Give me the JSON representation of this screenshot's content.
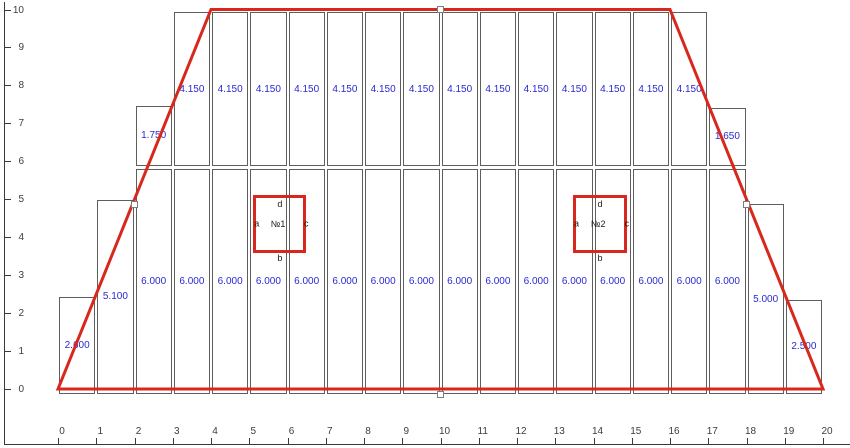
{
  "canvas": {
    "width": 850,
    "height": 448,
    "background": "#ffffff"
  },
  "colors": {
    "envelope_red": "#d8281e",
    "value_blue": "#2a2ace",
    "cell_border_gray": "#5e5e5e",
    "axis_gray": "#3a3a3a",
    "handle_fill": "#ffffff",
    "handle_border": "#7d7d7d"
  },
  "axes": {
    "x": {
      "min": 0,
      "max": 20,
      "tick_labels": [
        "0",
        "1",
        "2",
        "3",
        "4",
        "5",
        "6",
        "7",
        "8",
        "9",
        "10",
        "11",
        "12",
        "13",
        "14",
        "15",
        "16",
        "17",
        "18",
        "19",
        "20"
      ]
    },
    "y": {
      "min": 0,
      "max": 10,
      "tick_labels": [
        "0",
        "1",
        "2",
        "3",
        "4",
        "5",
        "6",
        "7",
        "8",
        "9",
        "10"
      ]
    }
  },
  "envelope": {
    "points": [
      [
        0,
        0
      ],
      [
        4,
        10
      ],
      [
        16,
        10
      ],
      [
        20,
        0
      ]
    ],
    "closed": true,
    "stroke_width": 3
  },
  "handles": [
    {
      "u": 2,
      "v": 5,
      "dy": 5
    },
    {
      "u": 10,
      "v": 10,
      "dy": 0
    },
    {
      "u": 18,
      "v": 5,
      "dy": 5
    },
    {
      "u": 10,
      "v": 0,
      "dy": 5
    }
  ],
  "strips": {
    "cells": [
      {
        "x0": 0,
        "x1": 1,
        "y0": -0.13,
        "y1": 2.42,
        "value": "2.600"
      },
      {
        "x0": 1,
        "x1": 2,
        "y0": -0.13,
        "y1": 4.98,
        "value": "5.100"
      },
      {
        "x0": 2,
        "x1": 3,
        "y0": -0.13,
        "y1": 5.8,
        "value": "6.000"
      },
      {
        "x0": 3,
        "x1": 4,
        "y0": -0.13,
        "y1": 5.8,
        "value": "6.000"
      },
      {
        "x0": 4,
        "x1": 5,
        "y0": -0.13,
        "y1": 5.8,
        "value": "6.000"
      },
      {
        "x0": 5,
        "x1": 6,
        "y0": -0.13,
        "y1": 5.8,
        "value": "6.000"
      },
      {
        "x0": 6,
        "x1": 7,
        "y0": -0.13,
        "y1": 5.8,
        "value": "6.000"
      },
      {
        "x0": 7,
        "x1": 8,
        "y0": -0.13,
        "y1": 5.8,
        "value": "6.000"
      },
      {
        "x0": 8,
        "x1": 9,
        "y0": -0.13,
        "y1": 5.8,
        "value": "6.000"
      },
      {
        "x0": 9,
        "x1": 10,
        "y0": -0.13,
        "y1": 5.8,
        "value": "6.000"
      },
      {
        "x0": 10,
        "x1": 11,
        "y0": -0.13,
        "y1": 5.8,
        "value": "6.000"
      },
      {
        "x0": 11,
        "x1": 12,
        "y0": -0.13,
        "y1": 5.8,
        "value": "6.000"
      },
      {
        "x0": 12,
        "x1": 13,
        "y0": -0.13,
        "y1": 5.8,
        "value": "6.000"
      },
      {
        "x0": 13,
        "x1": 14,
        "y0": -0.13,
        "y1": 5.8,
        "value": "6.000"
      },
      {
        "x0": 14,
        "x1": 15,
        "y0": -0.13,
        "y1": 5.8,
        "value": "6.000"
      },
      {
        "x0": 15,
        "x1": 16,
        "y0": -0.13,
        "y1": 5.8,
        "value": "6.000"
      },
      {
        "x0": 16,
        "x1": 17,
        "y0": -0.13,
        "y1": 5.8,
        "value": "6.000"
      },
      {
        "x0": 17,
        "x1": 18,
        "y0": -0.13,
        "y1": 5.8,
        "value": "6.000"
      },
      {
        "x0": 2,
        "x1": 3,
        "y0": 5.88,
        "y1": 7.47,
        "value": "1.750"
      },
      {
        "x0": 3,
        "x1": 4,
        "y0": 5.88,
        "y1": 9.93,
        "value": "4.150"
      },
      {
        "x0": 4,
        "x1": 5,
        "y0": 5.88,
        "y1": 9.93,
        "value": "4.150"
      },
      {
        "x0": 5,
        "x1": 6,
        "y0": 5.88,
        "y1": 9.93,
        "value": "4.150"
      },
      {
        "x0": 6,
        "x1": 7,
        "y0": 5.88,
        "y1": 9.93,
        "value": "4.150"
      },
      {
        "x0": 7,
        "x1": 8,
        "y0": 5.88,
        "y1": 9.93,
        "value": "4.150"
      },
      {
        "x0": 8,
        "x1": 9,
        "y0": 5.88,
        "y1": 9.93,
        "value": "4.150"
      },
      {
        "x0": 9,
        "x1": 10,
        "y0": 5.88,
        "y1": 9.93,
        "value": "4.150"
      },
      {
        "x0": 10,
        "x1": 11,
        "y0": 5.88,
        "y1": 9.93,
        "value": "4.150"
      },
      {
        "x0": 11,
        "x1": 12,
        "y0": 5.88,
        "y1": 9.93,
        "value": "4.150"
      },
      {
        "x0": 12,
        "x1": 13,
        "y0": 5.88,
        "y1": 9.93,
        "value": "4.150"
      },
      {
        "x0": 13,
        "x1": 14,
        "y0": 5.88,
        "y1": 9.93,
        "value": "4.150"
      },
      {
        "x0": 14,
        "x1": 15,
        "y0": 5.88,
        "y1": 9.93,
        "value": "4.150"
      },
      {
        "x0": 15,
        "x1": 16,
        "y0": 5.88,
        "y1": 9.93,
        "value": "4.150"
      },
      {
        "x0": 16,
        "x1": 17,
        "y0": 5.88,
        "y1": 9.93,
        "value": "4.150"
      },
      {
        "x0": 17,
        "x1": 18,
        "y0": 5.88,
        "y1": 7.4,
        "value": "1.650"
      },
      {
        "x0": 18,
        "x1": 19,
        "y0": -0.13,
        "y1": 4.87,
        "value": "5.000"
      },
      {
        "x0": 19,
        "x1": 20,
        "y0": -0.13,
        "y1": 2.35,
        "value": "2.500"
      }
    ]
  },
  "openings": [
    {
      "id": "№1",
      "x0": 5.13,
      "x1": 6.47,
      "y0": 3.62,
      "y1": 5.08,
      "letters": {
        "left": "a",
        "bottom": "b",
        "right": "c",
        "top": "d"
      }
    },
    {
      "id": "№2",
      "x0": 13.49,
      "x1": 14.85,
      "y0": 3.62,
      "y1": 5.08,
      "letters": {
        "left": "a",
        "bottom": "b",
        "right": "c",
        "top": "d"
      }
    }
  ]
}
